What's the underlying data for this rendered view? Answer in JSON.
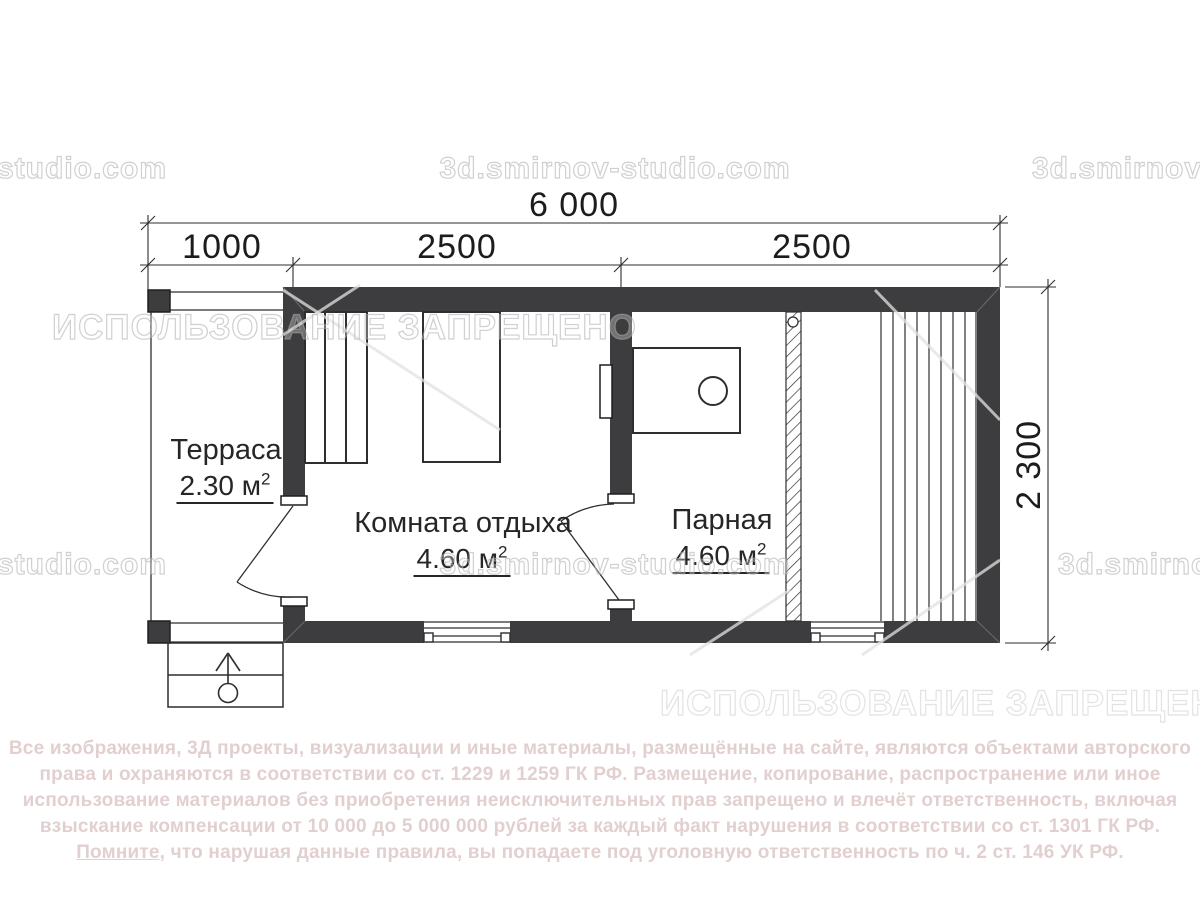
{
  "dimensions": {
    "total_width": "6 000",
    "seg1": "1000",
    "seg2": "2500",
    "seg3": "2500",
    "depth": "2 300"
  },
  "rooms": {
    "terrace": {
      "name": "Терраса",
      "area": "2.30 м",
      "area_sup": "2"
    },
    "lounge": {
      "name": "Комната отдыха",
      "area": "4.60 м",
      "area_sup": "2"
    },
    "steam": {
      "name": "Парная",
      "area": "4.60 м",
      "area_sup": "2"
    }
  },
  "watermarks": {
    "site_partial_left": "-studio.com",
    "site_full": "3d.smirnov-studio.com",
    "site_partial_right": "3d.smirnov-",
    "usage_forbidden": "ИСПОЛЬЗОВАНИЕ ЗАПРЕЩЕНО"
  },
  "legal": {
    "line1": "Все изображения, 3Д проекты, визуализации и иные материалы, размещённые на сайте, являются объектами авторского",
    "line2": "права и охраняются в соответствии со ст. 1229 и 1259 ГК РФ. Размещение, копирование, распространение или иное",
    "line3": "использование материалов без приобретения неисключительных прав запрещено и влечёт ответственность, включая",
    "line4": "взыскание компенсации от 10 000 до 5 000 000 рублей за каждый факт нарушения в соответствии со ст. 1301 ГК РФ.",
    "line5_underlined": "Помните,",
    "line5_rest": " что нарушая данные правила, вы попадаете под уголовную ответственность по ч. 2 ст. 146 УК РФ."
  },
  "colors": {
    "wall": "#3d3d3f",
    "line": "#2e2e2e",
    "legal_text": "#e2d0d0"
  }
}
